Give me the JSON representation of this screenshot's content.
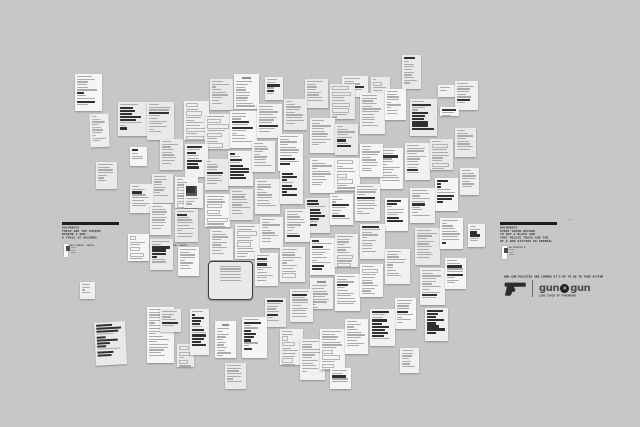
{
  "canvas": {
    "width": 640,
    "height": 427,
    "background": "#c6c7c9"
  },
  "left_panel": {
    "lines": [
      "DOCUMENTS",
      "THESE ARE THE PAPERS",
      "BEHIND A GUN:",
      "A TRAIL OF RECORDS"
    ],
    "cards": [
      {
        "side_lines": [
          "REG 2700",
          "CAL .38",
          "1971"
        ]
      },
      {
        "side_lines": [
          "REG 2701",
          "CAL .38",
          "1971"
        ]
      }
    ]
  },
  "right_panel": {
    "corner_mark": "--",
    "lines": [
      "DOCUMENTS",
      "EVERY PAPER RECORD",
      "TO BUY A BLACK GUN",
      "THAT POLICE TRACE AND THE",
      "OF A GUN STATION IN GENERAL"
    ],
    "card": {
      "side_lines": [
        "NO 2700",
        "TYPE B"
      ]
    }
  },
  "campaign": {
    "headline": "NEW GUN POLICIES ARE COMING IT'S UP TO US TO TAKE ACTION",
    "logo": {
      "word_left": "gun",
      "x_glyph": "✕",
      "word_right": "gun",
      "sub_tagline": "LONG CHAIN OF PAPERWORK"
    },
    "accent": "#1d1d1d",
    "logo_color": "#4b4b4b"
  },
  "collage": {
    "paper_shades": [
      "#f5f5f4",
      "#efefee",
      "#e9e9e8",
      "#f1f1f0"
    ],
    "line_color": "#ababab",
    "dark_color": "#2f2f2f",
    "doc_format": [
      "x",
      "y",
      "w",
      "h",
      "rot",
      "type",
      "seed"
    ],
    "documents": [
      [
        402,
        55,
        19,
        34,
        0,
        "receipt",
        11
      ],
      [
        342,
        76,
        26,
        21,
        0,
        "text",
        12
      ],
      [
        371,
        77,
        19,
        25,
        0,
        "form",
        13
      ],
      [
        265,
        77,
        18,
        23,
        0,
        "sm",
        14
      ],
      [
        75,
        74,
        27,
        37,
        0,
        "text",
        15
      ],
      [
        305,
        79,
        23,
        29,
        0,
        "text",
        16
      ],
      [
        330,
        84,
        25,
        35,
        0,
        "form",
        17
      ],
      [
        360,
        93,
        25,
        41,
        0,
        "text",
        18
      ],
      [
        385,
        89,
        21,
        31,
        0,
        "text",
        19
      ],
      [
        438,
        85,
        17,
        12,
        0,
        "sm",
        20
      ],
      [
        455,
        81,
        23,
        29,
        0,
        "text",
        21
      ],
      [
        210,
        79,
        23,
        31,
        0,
        "text",
        22
      ],
      [
        234,
        74,
        25,
        35,
        0,
        "letter",
        23
      ],
      [
        90,
        114,
        19,
        33,
        -2,
        "text",
        24
      ],
      [
        118,
        102,
        29,
        34,
        0,
        "dense",
        25
      ],
      [
        147,
        102,
        27,
        38,
        0,
        "text",
        26
      ],
      [
        184,
        101,
        25,
        39,
        0,
        "form",
        27
      ],
      [
        205,
        114,
        25,
        35,
        0,
        "form",
        28
      ],
      [
        230,
        111,
        27,
        37,
        0,
        "text",
        29
      ],
      [
        257,
        104,
        25,
        34,
        0,
        "text",
        30
      ],
      [
        284,
        99,
        23,
        31,
        0,
        "form",
        31
      ],
      [
        310,
        118,
        25,
        35,
        0,
        "text",
        32
      ],
      [
        335,
        124,
        23,
        31,
        0,
        "dense",
        33
      ],
      [
        410,
        99,
        27,
        37,
        0,
        "dense",
        34
      ],
      [
        440,
        107,
        19,
        9,
        0,
        "label",
        35
      ],
      [
        405,
        143,
        25,
        37,
        0,
        "text",
        36
      ],
      [
        430,
        139,
        23,
        31,
        0,
        "form",
        37
      ],
      [
        455,
        128,
        21,
        29,
        0,
        "text",
        38
      ],
      [
        130,
        147,
        17,
        19,
        0,
        "receipt",
        39
      ],
      [
        160,
        139,
        23,
        31,
        0,
        "text",
        40
      ],
      [
        185,
        144,
        23,
        33,
        0,
        "dense",
        41
      ],
      [
        96,
        162,
        21,
        27,
        0,
        "text",
        42
      ],
      [
        228,
        151,
        25,
        35,
        0,
        "dense",
        43
      ],
      [
        252,
        141,
        23,
        31,
        0,
        "text",
        44
      ],
      [
        278,
        134,
        25,
        37,
        0,
        "text",
        45
      ],
      [
        380,
        148,
        23,
        41,
        0,
        "text",
        46
      ],
      [
        152,
        174,
        21,
        29,
        0,
        "text",
        47
      ],
      [
        175,
        177,
        23,
        31,
        0,
        "form",
        48
      ],
      [
        130,
        184,
        23,
        29,
        0,
        "text",
        49
      ],
      [
        205,
        159,
        23,
        31,
        0,
        "text",
        50
      ],
      [
        310,
        158,
        25,
        35,
        0,
        "text",
        51
      ],
      [
        335,
        158,
        25,
        33,
        0,
        "form",
        52
      ],
      [
        360,
        144,
        23,
        33,
        0,
        "text",
        53
      ],
      [
        460,
        168,
        19,
        27,
        0,
        "text",
        54
      ],
      [
        184,
        183,
        19,
        25,
        0,
        "photo",
        55
      ],
      [
        205,
        194,
        25,
        33,
        0,
        "form",
        56
      ],
      [
        230,
        189,
        23,
        31,
        0,
        "text",
        57
      ],
      [
        255,
        179,
        25,
        35,
        0,
        "text",
        58
      ],
      [
        280,
        171,
        23,
        33,
        0,
        "dense",
        59
      ],
      [
        150,
        204,
        21,
        31,
        0,
        "text",
        60
      ],
      [
        175,
        209,
        23,
        33,
        0,
        "text",
        61
      ],
      [
        305,
        198,
        25,
        35,
        0,
        "dense",
        62
      ],
      [
        330,
        194,
        23,
        31,
        0,
        "text",
        63
      ],
      [
        355,
        184,
        25,
        37,
        0,
        "text",
        64
      ],
      [
        385,
        198,
        23,
        33,
        0,
        "dense",
        65
      ],
      [
        435,
        178,
        23,
        33,
        0,
        "dense",
        66
      ],
      [
        410,
        188,
        25,
        35,
        0,
        "text",
        67
      ],
      [
        210,
        229,
        23,
        31,
        0,
        "text",
        68
      ],
      [
        235,
        224,
        25,
        35,
        0,
        "form",
        69
      ],
      [
        260,
        217,
        23,
        31,
        0,
        "text",
        70
      ],
      [
        285,
        209,
        25,
        33,
        0,
        "text",
        71
      ],
      [
        128,
        234,
        21,
        27,
        0,
        "form",
        72
      ],
      [
        150,
        239,
        23,
        31,
        0,
        "dense",
        73
      ],
      [
        178,
        247,
        21,
        29,
        0,
        "text",
        74
      ],
      [
        310,
        238,
        25,
        37,
        0,
        "text",
        75
      ],
      [
        335,
        234,
        23,
        33,
        0,
        "form",
        76
      ],
      [
        360,
        224,
        25,
        35,
        0,
        "text",
        77
      ],
      [
        415,
        228,
        25,
        37,
        0,
        "form",
        78
      ],
      [
        440,
        218,
        23,
        31,
        0,
        "text",
        79
      ],
      [
        468,
        224,
        17,
        23,
        0,
        "sm",
        80
      ],
      [
        255,
        253,
        23,
        33,
        0,
        "text",
        81
      ],
      [
        280,
        247,
        25,
        35,
        0,
        "form",
        82
      ],
      [
        208,
        261,
        45,
        39,
        0,
        "cert",
        83
      ],
      [
        310,
        278,
        23,
        31,
        0,
        "letter",
        85
      ],
      [
        335,
        274,
        25,
        37,
        0,
        "text",
        86
      ],
      [
        360,
        264,
        23,
        33,
        0,
        "form",
        87
      ],
      [
        385,
        249,
        25,
        35,
        0,
        "text",
        88
      ],
      [
        420,
        268,
        25,
        37,
        0,
        "text",
        89
      ],
      [
        445,
        258,
        21,
        31,
        0,
        "text",
        90
      ],
      [
        265,
        298,
        21,
        29,
        0,
        "text",
        91
      ],
      [
        290,
        289,
        23,
        33,
        0,
        "text",
        92
      ],
      [
        80,
        282,
        15,
        17,
        0,
        "sm",
        93
      ],
      [
        395,
        298,
        21,
        31,
        0,
        "text",
        94
      ],
      [
        95,
        322,
        31,
        43,
        -3,
        "dense",
        95
      ],
      [
        147,
        307,
        27,
        56,
        0,
        "text",
        96
      ],
      [
        160,
        309,
        21,
        23,
        0,
        "text",
        97
      ],
      [
        177,
        344,
        17,
        23,
        0,
        "form",
        98
      ],
      [
        190,
        309,
        19,
        46,
        0,
        "dense",
        99
      ],
      [
        215,
        321,
        21,
        37,
        0,
        "letter",
        100
      ],
      [
        242,
        317,
        25,
        41,
        0,
        "dense",
        101
      ],
      [
        225,
        363,
        21,
        26,
        0,
        "text",
        102
      ],
      [
        280,
        329,
        23,
        36,
        0,
        "form",
        103
      ],
      [
        300,
        339,
        25,
        41,
        0,
        "text",
        104
      ],
      [
        320,
        329,
        25,
        41,
        0,
        "form",
        105
      ],
      [
        345,
        319,
        23,
        35,
        0,
        "text",
        106
      ],
      [
        370,
        309,
        25,
        37,
        0,
        "dense",
        107
      ],
      [
        425,
        308,
        23,
        33,
        0,
        "dense",
        108
      ],
      [
        400,
        348,
        19,
        25,
        0,
        "text",
        109
      ],
      [
        330,
        368,
        21,
        21,
        0,
        "sm",
        110
      ]
    ]
  }
}
